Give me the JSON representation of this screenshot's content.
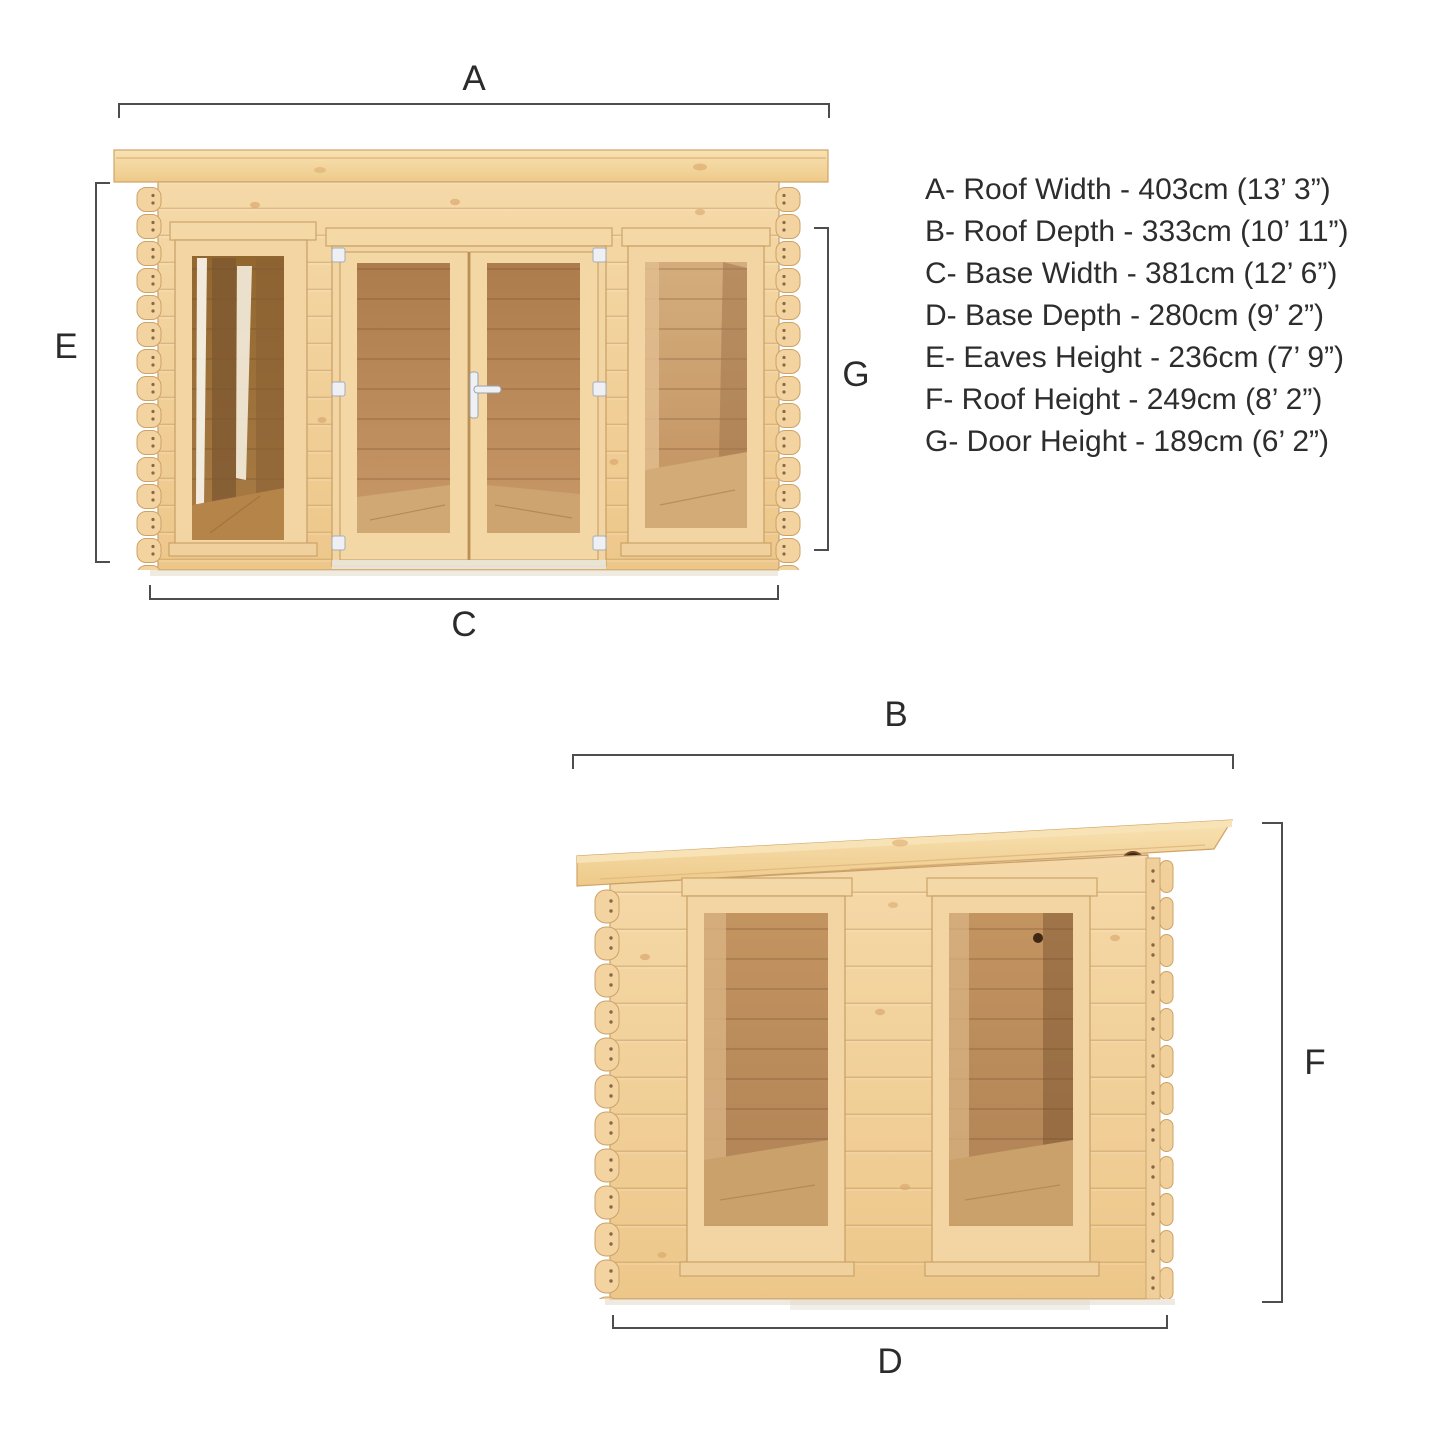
{
  "page": {
    "description": "Log cabin product dimension diagram with front and side elevations",
    "background": "#ffffff"
  },
  "colors": {
    "wood_light": "#f5d8a6",
    "wood_mid": "#edc88c",
    "wood_frame": "#f6dcab",
    "wood_edge": "#c9a06a",
    "under_eave_shadow": "#d8a96d",
    "interior_dark": "#8a6136",
    "interior_mid": "#b8895a",
    "interior_floor": "#cfa573",
    "hardware_white": "#eef0f4",
    "dimension_line": "#4d4d4d",
    "label_text": "#2b2b2b"
  },
  "front_elevation": {
    "name": "front-elevation",
    "features": [
      "roof-overhang",
      "left-window",
      "double-glazed-doors",
      "right-window",
      "log-end-corners"
    ]
  },
  "side_elevation": {
    "name": "side-elevation",
    "features": [
      "sloped-pent-roof",
      "vent-hole",
      "two-windows",
      "log-end-corners"
    ]
  },
  "dimension_key": {
    "items": [
      {
        "letter": "A",
        "label": "Roof Width",
        "metric": "403cm",
        "imperial": "13’ 3”",
        "text": "A- Roof Width - 403cm (13’ 3”)"
      },
      {
        "letter": "B",
        "label": "Roof Depth",
        "metric": "333cm",
        "imperial": "10’ 11”",
        "text": "B- Roof Depth - 333cm (10’ 11”)"
      },
      {
        "letter": "C",
        "label": "Base Width",
        "metric": "381cm",
        "imperial": "12’ 6”",
        "text": "C- Base Width - 381cm (12’ 6”)"
      },
      {
        "letter": "D",
        "label": "Base Depth",
        "metric": "280cm",
        "imperial": "9’ 2”",
        "text": "D- Base Depth - 280cm (9’ 2”)"
      },
      {
        "letter": "E",
        "label": "Eaves Height",
        "metric": "236cm",
        "imperial": "7’ 9”",
        "text": "E- Eaves Height - 236cm (7’ 9”)"
      },
      {
        "letter": "F",
        "label": "Roof Height",
        "metric": "249cm",
        "imperial": "8’ 2”",
        "text": "F- Roof Height - 249cm (8’ 2”)"
      },
      {
        "letter": "G",
        "label": "Door Height",
        "metric": "189cm",
        "imperial": "6’ 2”",
        "text": "G- Door Height - 189cm (6’ 2”)"
      }
    ]
  }
}
